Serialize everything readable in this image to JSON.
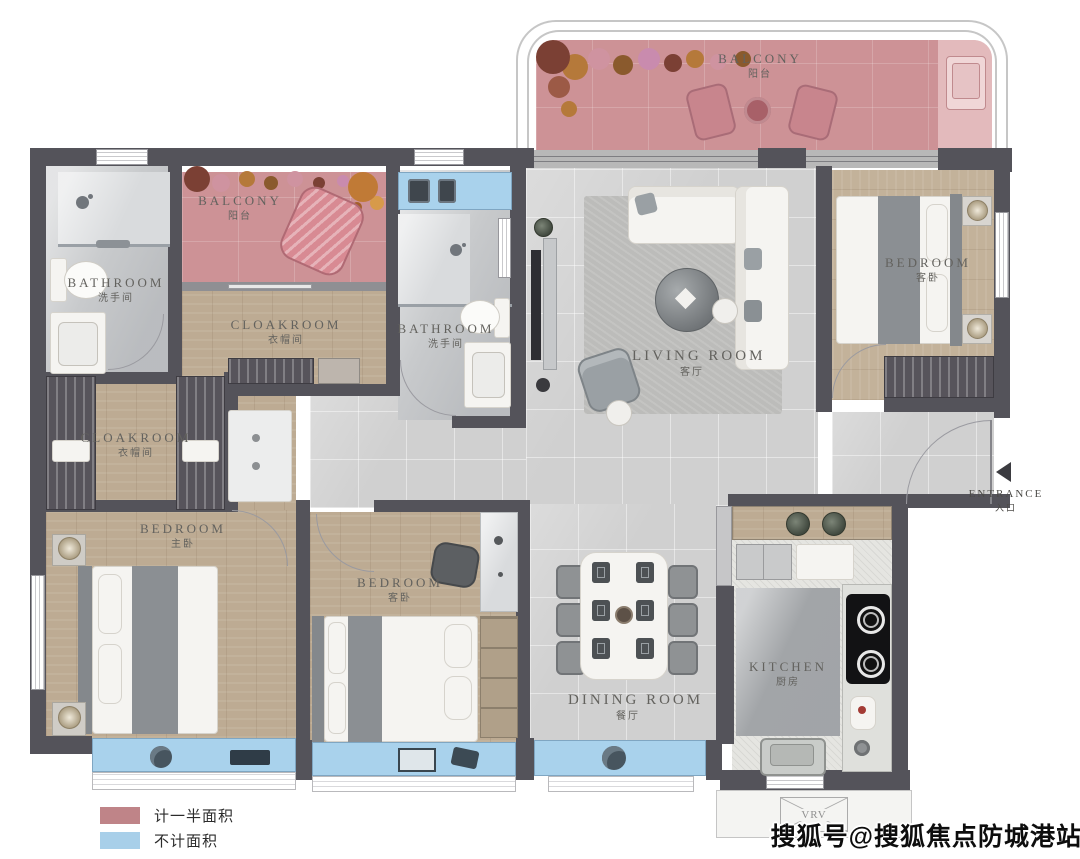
{
  "watermark": "搜狐号@搜狐焦点防城港站",
  "legend": {
    "half_area": {
      "label": "计一半面积",
      "color": "#bf8488"
    },
    "excluded_area": {
      "label": "不计面积",
      "color": "#a8cfe9"
    }
  },
  "rooms": {
    "balcony_main": {
      "en": "BALCONY",
      "zh": "阳台"
    },
    "balcony_small": {
      "en": "BALCONY",
      "zh": "阳台"
    },
    "bathroom_left": {
      "en": "BATHROOM",
      "zh": "洗手间"
    },
    "bathroom_middle": {
      "en": "BATHROOM",
      "zh": "洗手间"
    },
    "cloakroom_top": {
      "en": "CLOAKROOM",
      "zh": "衣帽间"
    },
    "cloakroom_left": {
      "en": "CLOAKROOM",
      "zh": "衣帽间"
    },
    "living_room": {
      "en": "LIVING ROOM",
      "zh": "客厅"
    },
    "dining_room": {
      "en": "DINING ROOM",
      "zh": "餐厅"
    },
    "kitchen": {
      "en": "KITCHEN",
      "zh": "厨房"
    },
    "bedroom_guest_top": {
      "en": "BEDROOM",
      "zh": "客卧"
    },
    "bedroom_master": {
      "en": "BEDROOM",
      "zh": "主卧"
    },
    "bedroom_guest_mid": {
      "en": "BEDROOM",
      "zh": "客卧"
    },
    "entrance": {
      "en": "ENTRANCE",
      "zh": "入口"
    }
  },
  "labels": {
    "vrv": "VRV"
  },
  "colors": {
    "wall": "#54535a",
    "half_area_pink": "#cd9296",
    "excluded_blue": "#a9d2ec",
    "wood_floor": "#bdab93",
    "tile_floor": "#d0d0d0"
  }
}
